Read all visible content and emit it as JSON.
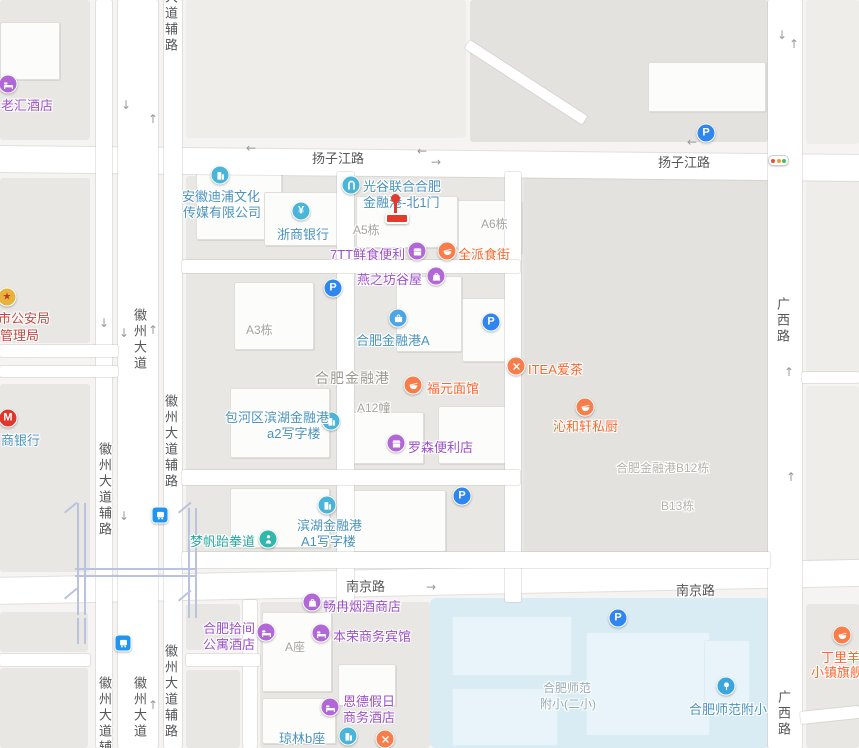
{
  "map": {
    "colors": {
      "purple_icon": "#b168d6",
      "purple_text": "#9c50c8",
      "orange_icon": "#f87d4a",
      "orange_text": "#f8672f",
      "blue_icon": "#4ab5d9",
      "blue_text": "#4a93bd",
      "teal_icon": "#30b8ad",
      "teal_text": "#27a79a",
      "red_icon": "#e8b33c",
      "red_text": "#bf4a42",
      "parking_blue": "#2e86ee",
      "bus_blue": "#1e95f2",
      "pin_red": "#e23a2b",
      "cmb_red": "#e0372c",
      "traffic_red": "#e84c3d",
      "traffic_yellow": "#f29b2d",
      "traffic_green": "#3fc05a"
    },
    "blocks": [
      {
        "x": 0,
        "y": 0,
        "w": 90,
        "h": 140,
        "f": "b"
      },
      {
        "x": 186,
        "y": 0,
        "w": 280,
        "h": 138,
        "f": "bl"
      },
      {
        "x": 470,
        "y": 0,
        "w": 298,
        "h": 142,
        "f": "bd"
      },
      {
        "x": 806,
        "y": 0,
        "w": 53,
        "h": 144,
        "f": "bl"
      },
      {
        "x": 0,
        "y": 178,
        "w": 90,
        "h": 165,
        "f": "b"
      },
      {
        "x": 0,
        "y": 384,
        "w": 90,
        "h": 188,
        "f": "b"
      },
      {
        "x": 0,
        "y": 612,
        "w": 88,
        "h": 40,
        "f": "b"
      },
      {
        "x": 0,
        "y": 668,
        "w": 88,
        "h": 80,
        "f": "b"
      },
      {
        "x": 186,
        "y": 176,
        "w": 582,
        "h": 390,
        "f": "b"
      },
      {
        "x": 524,
        "y": 176,
        "w": 244,
        "h": 388,
        "f": "bd"
      },
      {
        "x": 806,
        "y": 176,
        "w": 53,
        "h": 196,
        "f": "bl"
      },
      {
        "x": 806,
        "y": 386,
        "w": 53,
        "h": 188,
        "f": "bl"
      },
      {
        "x": 806,
        "y": 604,
        "w": 53,
        "h": 144,
        "f": "b"
      },
      {
        "x": 186,
        "y": 604,
        "w": 54,
        "h": 46,
        "f": "b"
      },
      {
        "x": 186,
        "y": 670,
        "w": 54,
        "h": 78,
        "f": "b"
      },
      {
        "x": 260,
        "y": 602,
        "w": 170,
        "h": 146,
        "f": "b"
      },
      {
        "x": 430,
        "y": 598,
        "w": 340,
        "h": 150,
        "f": "w"
      }
    ],
    "buildings": [
      {
        "x": 0,
        "y": 22,
        "w": 58,
        "h": 56
      },
      {
        "x": 196,
        "y": 168,
        "w": 84,
        "h": 70
      },
      {
        "x": 264,
        "y": 192,
        "w": 76,
        "h": 52
      },
      {
        "x": 356,
        "y": 196,
        "w": 100,
        "h": 50
      },
      {
        "x": 458,
        "y": 200,
        "w": 62,
        "h": 52
      },
      {
        "x": 234,
        "y": 282,
        "w": 78,
        "h": 66
      },
      {
        "x": 396,
        "y": 276,
        "w": 64,
        "h": 74
      },
      {
        "x": 462,
        "y": 298,
        "w": 44,
        "h": 62
      },
      {
        "x": 230,
        "y": 388,
        "w": 98,
        "h": 68
      },
      {
        "x": 352,
        "y": 412,
        "w": 70,
        "h": 50
      },
      {
        "x": 438,
        "y": 406,
        "w": 68,
        "h": 56
      },
      {
        "x": 230,
        "y": 488,
        "w": 98,
        "h": 58
      },
      {
        "x": 336,
        "y": 490,
        "w": 108,
        "h": 60
      },
      {
        "x": 648,
        "y": 62,
        "w": 116,
        "h": 48
      },
      {
        "x": 262,
        "y": 612,
        "w": 68,
        "h": 78
      },
      {
        "x": 338,
        "y": 664,
        "w": 56,
        "h": 40
      },
      {
        "x": 262,
        "y": 698,
        "w": 72,
        "h": 44
      }
    ],
    "water_buildings": [
      {
        "x": 452,
        "y": 616,
        "w": 118,
        "h": 58
      },
      {
        "x": 452,
        "y": 688,
        "w": 104,
        "h": 56
      },
      {
        "x": 586,
        "y": 632,
        "w": 122,
        "h": 102
      },
      {
        "x": 704,
        "y": 640,
        "w": 44,
        "h": 64
      }
    ],
    "roads": [
      {
        "x": -5,
        "y": 146,
        "w": 870,
        "h": 26,
        "r": 0.6
      },
      {
        "x": -5,
        "y": 578,
        "w": 870,
        "h": 26,
        "r": -1.2
      },
      {
        "x": 96,
        "y": 0,
        "w": 16,
        "h": 748
      },
      {
        "x": 118,
        "y": 0,
        "w": 40,
        "h": 748
      },
      {
        "x": 164,
        "y": 0,
        "w": 18,
        "h": 748
      },
      {
        "x": 768,
        "y": 0,
        "w": 34,
        "h": 748
      },
      {
        "x": 337,
        "y": 172,
        "w": 17,
        "h": 430
      },
      {
        "x": 505,
        "y": 172,
        "w": 16,
        "h": 430
      },
      {
        "x": 182,
        "y": 260,
        "w": 338,
        "h": 13
      },
      {
        "x": 182,
        "y": 470,
        "w": 338,
        "h": 15
      },
      {
        "x": 182,
        "y": 552,
        "w": 588,
        "h": 16
      },
      {
        "x": 0,
        "y": 345,
        "w": 118,
        "h": 12
      },
      {
        "x": 0,
        "y": 366,
        "w": 118,
        "h": 11
      },
      {
        "x": 243,
        "y": 600,
        "w": 14,
        "h": 148
      },
      {
        "x": 0,
        "y": 654,
        "w": 90,
        "h": 12
      },
      {
        "x": 186,
        "y": 654,
        "w": 74,
        "h": 12
      },
      {
        "x": 802,
        "y": 372,
        "w": 57,
        "h": 11
      },
      {
        "x": 800,
        "y": 712,
        "w": 59,
        "h": 12,
        "r": -6
      },
      {
        "x": 470,
        "y": 40,
        "w": 140,
        "h": 10,
        "r": 33
      }
    ],
    "rail_segments": [
      {
        "x": 77,
        "y": 503,
        "w": 2,
        "h": 112
      },
      {
        "x": 84,
        "y": 503,
        "w": 2,
        "h": 112
      },
      {
        "x": 188,
        "y": 508,
        "w": 2,
        "h": 110
      },
      {
        "x": 195,
        "y": 508,
        "w": 2,
        "h": 110
      },
      {
        "x": 75,
        "y": 568,
        "w": 122,
        "h": 2
      },
      {
        "x": 75,
        "y": 575,
        "w": 122,
        "h": 2
      },
      {
        "x": 77,
        "y": 618,
        "w": 2,
        "h": 26
      },
      {
        "x": 84,
        "y": 618,
        "w": 2,
        "h": 26
      },
      {
        "x": 64,
        "y": 512,
        "w": 16,
        "h": 2,
        "r": -40
      },
      {
        "x": 178,
        "y": 512,
        "w": 16,
        "h": 2,
        "r": -40
      },
      {
        "x": 64,
        "y": 598,
        "w": 16,
        "h": 2,
        "r": -40
      },
      {
        "x": 178,
        "y": 600,
        "w": 16,
        "h": 2,
        "r": -40
      }
    ],
    "arrows": [
      {
        "d": "down",
        "x": 121,
        "y": 99
      },
      {
        "d": "up",
        "x": 148,
        "y": 113
      },
      {
        "d": "left",
        "x": 246,
        "y": 142
      },
      {
        "d": "left",
        "x": 417,
        "y": 145
      },
      {
        "d": "right",
        "x": 431,
        "y": 156
      },
      {
        "d": "left",
        "x": 687,
        "y": 136
      },
      {
        "d": "down",
        "x": 777,
        "y": 29
      },
      {
        "d": "up",
        "x": 789,
        "y": 38
      },
      {
        "d": "down",
        "x": 99,
        "y": 317
      },
      {
        "d": "down",
        "x": 119,
        "y": 327
      },
      {
        "d": "up",
        "x": 148,
        "y": 324
      },
      {
        "d": "down",
        "x": 119,
        "y": 510
      },
      {
        "d": "up",
        "x": 148,
        "y": 699
      },
      {
        "d": "right",
        "x": 426,
        "y": 581
      },
      {
        "d": "up",
        "x": 784,
        "y": 366
      },
      {
        "d": "up",
        "x": 786,
        "y": 471
      }
    ],
    "road_labels": [
      {
        "t": "扬子江路",
        "x": 312,
        "y": 148
      },
      {
        "t": "扬子江路",
        "x": 658,
        "y": 152
      },
      {
        "t": "南京路",
        "x": 346,
        "y": 576
      },
      {
        "t": "南京路",
        "x": 676,
        "y": 580
      },
      {
        "t": "大道辅路",
        "x": 161,
        "y": -10,
        "v": 1
      },
      {
        "t": "徽州大道",
        "x": 130,
        "y": 308,
        "v": 1
      },
      {
        "t": "徽州大道辅路",
        "x": 95,
        "y": 442,
        "v": 1
      },
      {
        "t": "徽州大道辅路",
        "x": 161,
        "y": 394,
        "v": 1
      },
      {
        "t": "徽州大道辅路",
        "x": 95,
        "y": 676,
        "v": 1
      },
      {
        "t": "徽州大道",
        "x": 130,
        "y": 676,
        "v": 1
      },
      {
        "t": "徽州大道辅路",
        "x": 161,
        "y": 644,
        "v": 1
      },
      {
        "t": "广西路",
        "x": 773,
        "y": 297,
        "v": 1
      },
      {
        "t": "广西路",
        "x": 774,
        "y": 690,
        "v": 1
      }
    ],
    "area_labels": [
      {
        "t": "A5栋",
        "x": 353,
        "y": 221
      },
      {
        "t": "A6栋",
        "x": 481,
        "y": 215
      },
      {
        "t": "A3栋",
        "x": 246,
        "y": 321
      },
      {
        "t": "合肥金融港",
        "x": 315,
        "y": 368,
        "cls": "big"
      },
      {
        "t": "A12幢",
        "x": 357,
        "y": 399
      },
      {
        "t": "合肥金融港B12栋",
        "x": 616,
        "y": 459,
        "cls": "light"
      },
      {
        "t": "B13栋",
        "x": 661,
        "y": 497,
        "cls": "light"
      },
      {
        "t": "A座",
        "x": 285,
        "y": 638
      },
      {
        "t": "合肥师范",
        "x": 543,
        "y": 679,
        "cls": "water"
      },
      {
        "t": "附小(二小)",
        "x": 540,
        "y": 695,
        "cls": "water"
      }
    ],
    "pois": [
      {
        "name": "laohui-hotel",
        "scheme": "purple",
        "icon": {
          "t": "bed",
          "x": 8,
          "y": 84
        },
        "lines": [
          {
            "t": "老汇酒店",
            "x": 1,
            "y": 95
          }
        ]
      },
      {
        "name": "anhui-dipu-media",
        "scheme": "blue",
        "icon": {
          "t": "building",
          "x": 220,
          "y": 175
        },
        "lines": [
          {
            "t": "安徽迪浦文化",
            "x": 182,
            "y": 186
          },
          {
            "t": "传媒有限公司",
            "x": 183,
            "y": 202
          }
        ]
      },
      {
        "name": "zheshang-bank",
        "scheme": "blue",
        "icon": {
          "t": "yen",
          "x": 301,
          "y": 211
        },
        "lines": [
          {
            "t": "浙商银行",
            "x": 277,
            "y": 224
          }
        ]
      },
      {
        "name": "guanggu-north-gate-1",
        "scheme": "blue",
        "icon": {
          "t": "gate",
          "x": 351,
          "y": 185
        },
        "lines": [
          {
            "t": "光谷联合合肥",
            "x": 363,
            "y": 176
          },
          {
            "t": "金融港-北1门",
            "x": 363,
            "y": 192
          }
        ]
      },
      {
        "name": "7tt-fresh-food",
        "scheme": "purple",
        "icon": {
          "t": "store",
          "x": 417,
          "y": 251
        },
        "lines": [
          {
            "t": "7TT鲜食便利",
            "x": 330,
            "y": 244
          }
        ]
      },
      {
        "name": "quanpai-food-street",
        "scheme": "orange",
        "icon": {
          "t": "bowl",
          "x": 447,
          "y": 251
        },
        "lines": [
          {
            "t": "全派食街",
            "x": 458,
            "y": 244
          }
        ]
      },
      {
        "name": "yanzhifang-guwu",
        "scheme": "purple",
        "icon": {
          "t": "bag",
          "x": 436,
          "y": 276
        },
        "lines": [
          {
            "t": "燕之坊谷屋",
            "x": 357,
            "y": 269
          }
        ]
      },
      {
        "name": "hefei-financial-port-a",
        "scheme": "blue",
        "ic": "#4da6e2",
        "icon": {
          "t": "case",
          "x": 398,
          "y": 318
        },
        "lines": [
          {
            "t": "合肥金融港A",
            "x": 356,
            "y": 330
          }
        ]
      },
      {
        "name": "itea-tea",
        "scheme": "orange",
        "icon": {
          "t": "xfork",
          "x": 516,
          "y": 366
        },
        "lines": [
          {
            "t": "ITEA爱茶",
            "x": 528,
            "y": 359
          }
        ]
      },
      {
        "name": "fuyuan-noodle",
        "scheme": "orange",
        "icon": {
          "t": "bowl",
          "x": 413,
          "y": 385
        },
        "lines": [
          {
            "t": "福元面馆",
            "x": 427,
            "y": 378
          }
        ]
      },
      {
        "name": "baohequ-a2-office",
        "scheme": "blue",
        "icon": {
          "t": "building",
          "x": 331,
          "y": 421
        },
        "lines": [
          {
            "t": "包河区滨湖金融港",
            "x": 225,
            "y": 407
          },
          {
            "t": "a2写字楼",
            "x": 267,
            "y": 423
          }
        ]
      },
      {
        "name": "lawson-store",
        "scheme": "purple",
        "icon": {
          "t": "store",
          "x": 396,
          "y": 443
        },
        "lines": [
          {
            "t": "罗森便利店",
            "x": 408,
            "y": 437
          }
        ]
      },
      {
        "name": "qinhexuan-kitchen",
        "scheme": "orange",
        "icon": {
          "t": "bowl",
          "x": 585,
          "y": 407
        },
        "lines": [
          {
            "t": "沁和轩私厨",
            "x": 553,
            "y": 416
          }
        ]
      },
      {
        "name": "mengfan-taekwondo",
        "scheme": "teal",
        "icon": {
          "t": "person",
          "x": 268,
          "y": 539
        },
        "lines": [
          {
            "t": "梦帆跆拳道",
            "x": 190,
            "y": 531
          }
        ]
      },
      {
        "name": "binhu-a1-office",
        "scheme": "blue",
        "icon": {
          "t": "building",
          "x": 327,
          "y": 505
        },
        "lines": [
          {
            "t": "滨湖金融港",
            "x": 297,
            "y": 515
          },
          {
            "t": "A1写字楼",
            "x": 301,
            "y": 531
          }
        ]
      },
      {
        "name": "changran-tobacco",
        "scheme": "purple",
        "icon": {
          "t": "bag",
          "x": 312,
          "y": 602
        },
        "lines": [
          {
            "t": "畅冉烟酒商店",
            "x": 323,
            "y": 596
          }
        ]
      },
      {
        "name": "hefei-shijian-apartment",
        "scheme": "purple",
        "icon": {
          "t": "bed",
          "x": 266,
          "y": 632
        },
        "lines": [
          {
            "t": "合肥拾间",
            "x": 203,
            "y": 618
          },
          {
            "t": "公寓酒店",
            "x": 203,
            "y": 634
          }
        ]
      },
      {
        "name": "benrong-hotel",
        "scheme": "purple",
        "icon": {
          "t": "bed",
          "x": 321,
          "y": 633
        },
        "lines": [
          {
            "t": "本荣商务宾馆",
            "x": 333,
            "y": 626
          }
        ]
      },
      {
        "name": "ende-holiday-hotel",
        "scheme": "purple",
        "icon": {
          "t": "bed",
          "x": 330,
          "y": 707
        },
        "lines": [
          {
            "t": "恩德假日",
            "x": 343,
            "y": 691
          },
          {
            "t": "商务酒店",
            "x": 343,
            "y": 707
          }
        ]
      },
      {
        "name": "qionglin-b",
        "scheme": "blue",
        "icon": {
          "t": "building",
          "x": 348,
          "y": 736
        },
        "lines": [
          {
            "t": "琼林b座",
            "x": 279,
            "y": 728
          }
        ]
      },
      {
        "name": "hefei-normal-primary",
        "scheme": "blue",
        "ic": "#3aa6db",
        "icon": {
          "t": "school",
          "x": 726,
          "y": 686
        },
        "lines": [
          {
            "t": "合肥师范附小",
            "x": 689,
            "y": 699
          }
        ]
      },
      {
        "name": "dingliyang-flagship",
        "scheme": "orange",
        "icon": {
          "t": "bowl",
          "x": 842,
          "y": 635
        },
        "lines": [
          {
            "t": "丁里羊",
            "x": 821,
            "y": 647
          },
          {
            "t": "小镇旗舰",
            "x": 811,
            "y": 662
          }
        ]
      },
      {
        "name": "cmb-bank",
        "scheme": "blue",
        "ic": "#e0372c",
        "icon": {
          "t": "mbank",
          "x": 8,
          "y": 418
        },
        "lines": [
          {
            "t": "商银行",
            "x": 1,
            "y": 430
          }
        ]
      },
      {
        "name": "police-bureau",
        "scheme": "red",
        "icon": {
          "t": "emblem",
          "x": 7,
          "y": 297
        },
        "lines": [
          {
            "t": "市公安局",
            "x": -2,
            "y": 308
          },
          {
            "t": "管理局",
            "x": 0,
            "y": 325
          }
        ]
      },
      {
        "name": "restaurant-unnamed",
        "scheme": "orange",
        "icon": {
          "t": "xfork",
          "x": 385,
          "y": 739
        },
        "lines": []
      }
    ],
    "parking_icons": [
      {
        "x": 706,
        "y": 133
      },
      {
        "x": 333,
        "y": 288
      },
      {
        "x": 491,
        "y": 322
      },
      {
        "x": 462,
        "y": 496
      },
      {
        "x": 618,
        "y": 618
      }
    ],
    "bus_icons": [
      {
        "x": 160,
        "y": 515
      },
      {
        "x": 123,
        "y": 643
      }
    ],
    "traffic_light": {
      "x": 777,
      "y": 160
    },
    "destination_pin": {
      "x": 396,
      "y": 194
    }
  }
}
